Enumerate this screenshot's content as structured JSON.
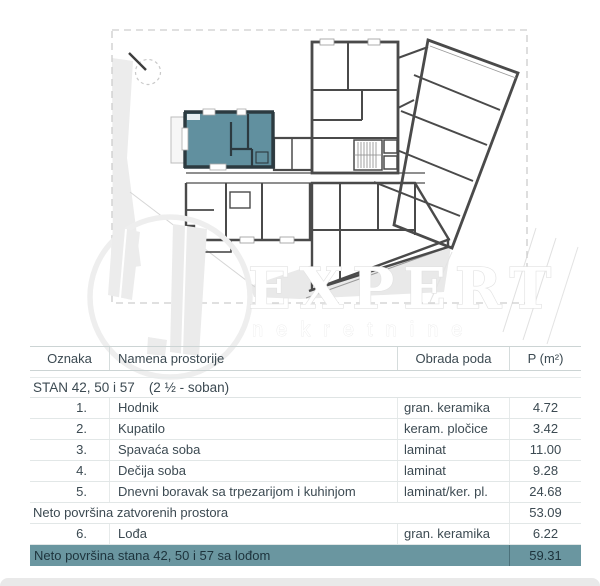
{
  "document": {
    "type": "apartment floor plan sheet"
  },
  "watermark": {
    "title": "EXPERT",
    "subtitle": "nekretnine",
    "logo": "buildings-in-circle"
  },
  "plan": {
    "highlight_color": "#61909f",
    "wall_color": "#4a4a4a",
    "compass": "north-indicator"
  },
  "colors": {
    "highlight_row_bg": "#6a96a0",
    "highlight_row_text": "#1d333c",
    "table_text": "#3c4a52",
    "grid_line": "#e2e7e7"
  },
  "table": {
    "headers": [
      "Oznaka",
      "Namena prostorije",
      "Obrada poda",
      "P (m²)"
    ],
    "section_title": "STAN 42, 50 i 57",
    "section_subtitle": "(2 ½ - soban)",
    "rows": [
      {
        "num": "1.",
        "name": "Hodnik",
        "floor": "gran. keramika",
        "area": "4.72"
      },
      {
        "num": "2.",
        "name": "Kupatilo",
        "floor": "keram. pločice",
        "area": "3.42"
      },
      {
        "num": "3.",
        "name": "Spavaća soba",
        "floor": "laminat",
        "area": "11.00"
      },
      {
        "num": "4.",
        "name": "Dečija soba",
        "floor": "laminat",
        "area": "9.28"
      },
      {
        "num": "5.",
        "name": "Dnevni boravak sa trpezarijom i kuhinjom",
        "floor": "laminat/ker. pl.",
        "area": "24.68"
      }
    ],
    "subtotal": {
      "label": "Neto površina zatvorenih prostora",
      "area": "53.09"
    },
    "loggia_row": {
      "num": "6.",
      "name": "Lođa",
      "floor": "gran. keramika",
      "area": "6.22"
    },
    "total": {
      "label": "Neto površina stana 42, 50 i 57 sa lođom",
      "area": "59.31"
    }
  }
}
